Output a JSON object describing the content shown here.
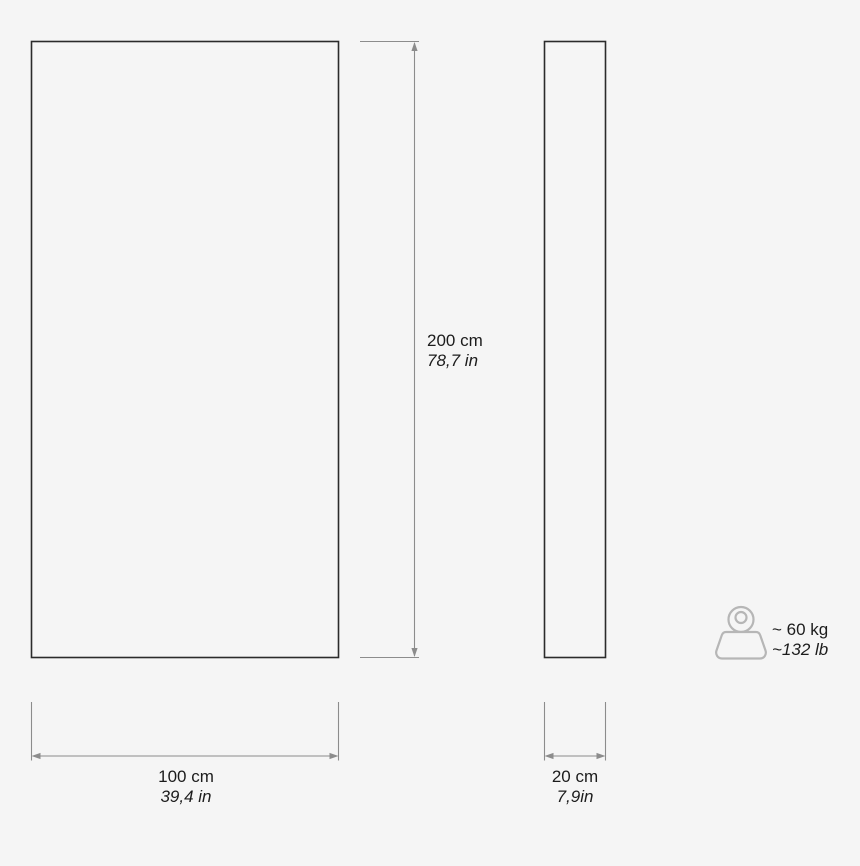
{
  "diagram_title": "product-dimension-diagram",
  "front_view": {
    "height": {
      "metric": "200 cm",
      "imperial": "78,7 in"
    },
    "width": {
      "metric": "100 cm",
      "imperial": "39,4 in"
    }
  },
  "side_view": {
    "depth": {
      "metric": "20 cm",
      "imperial": "7,9in"
    }
  },
  "weight": {
    "icon": "weight-icon",
    "metric": "~ 60 kg",
    "imperial": "~132 lb"
  },
  "colors": {
    "background": "#f5f5f5",
    "outline": "#2b2b2b",
    "scribble": "#2e2e2e",
    "dimension_line": "#8c8c8c",
    "weight_icon": "#b6b6b6",
    "text": "#1c1c1c"
  }
}
